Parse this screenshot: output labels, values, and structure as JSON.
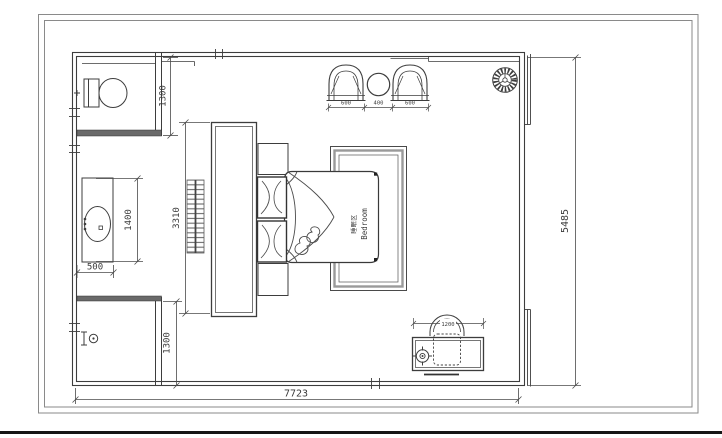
{
  "drawing": {
    "type": "bedroom-floor-plan",
    "room_label": {
      "zh": "睡眠区",
      "en": "Bedroom"
    },
    "dimensions": {
      "toilet_room_depth": "1300",
      "vanity_length": "1400",
      "vanity_width": "500",
      "wardrobe_run": "3310",
      "shower_room_depth": "1300",
      "armchair_left": "600",
      "side_table": "400",
      "armchair_right": "600",
      "desk_width": "1200",
      "plan_height": "5485",
      "plan_width": "7723"
    },
    "colors": {
      "line": "#3d3d3d",
      "dim_line": "#4a4a4a",
      "text": "#3a3a3a",
      "sill_fill": "#6a6a6a",
      "paper": "#ffffff",
      "bottom_bar": "#161616"
    }
  }
}
